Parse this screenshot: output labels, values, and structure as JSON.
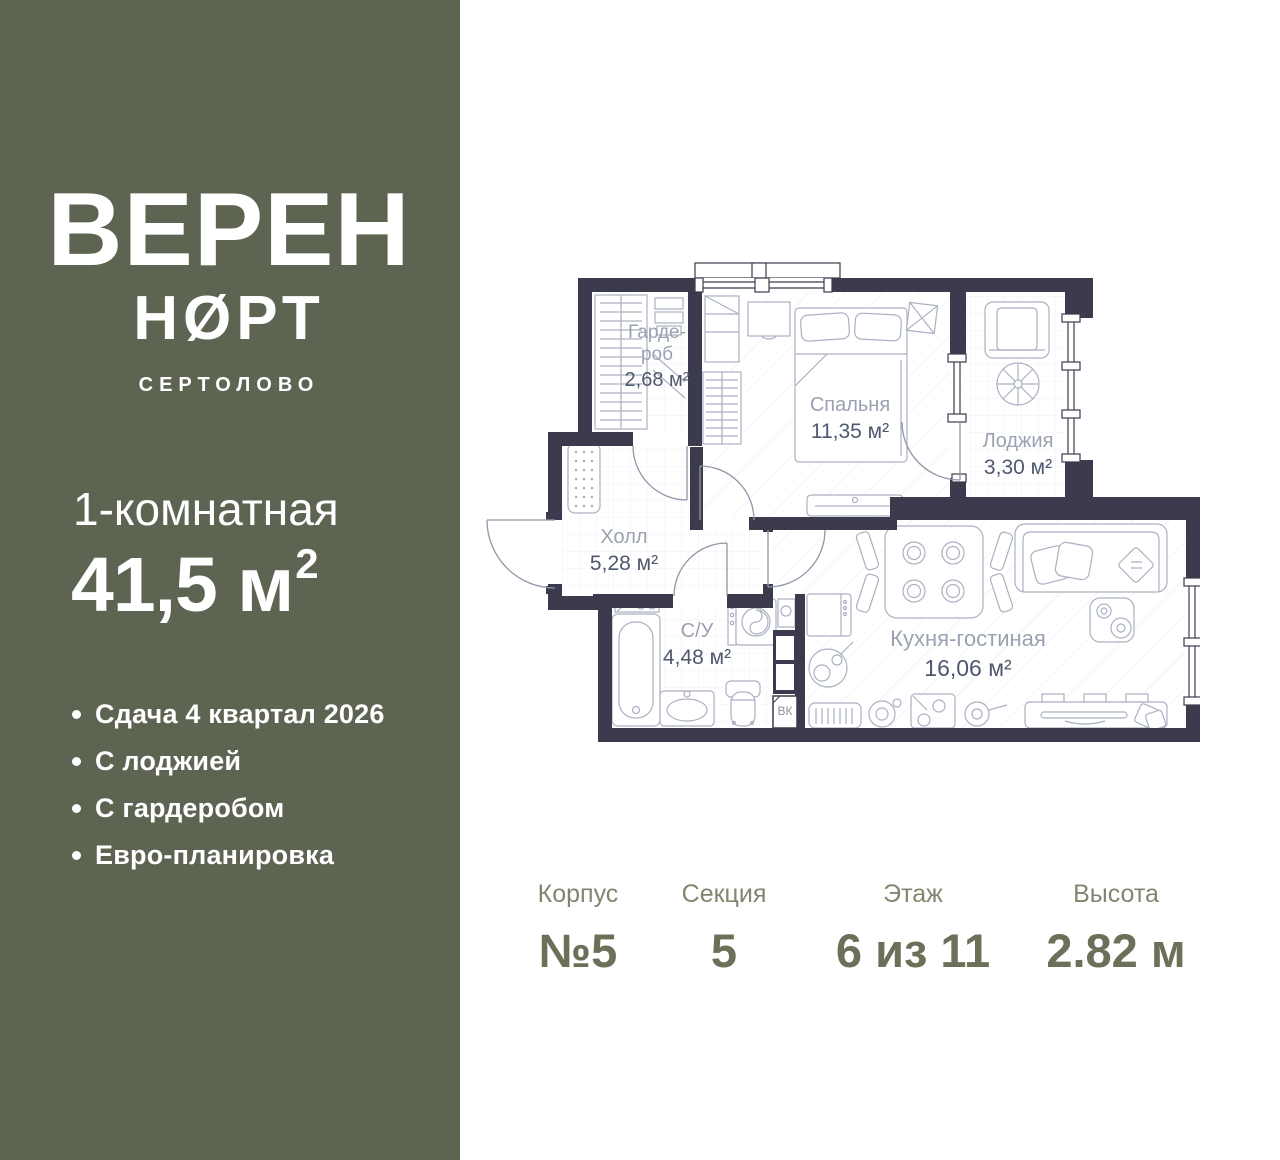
{
  "sidebar": {
    "brand": {
      "title": "ВЕРЕН",
      "subtitle": "НØРТ",
      "city": "СЕРТОЛОВО"
    },
    "apartment": {
      "type": "1-комнатная",
      "area": "41,5 м",
      "area_sup": "2"
    },
    "features": [
      "Сдача 4 квартал 2026",
      "С лоджией",
      "С гардеробом",
      "Евро-планировка"
    ]
  },
  "plan": {
    "rooms": [
      {
        "name": "Гарде-\nроб",
        "area": "2,68 м²"
      },
      {
        "name": "Спальня",
        "area": "11,35 м²"
      },
      {
        "name": "Лоджия",
        "area": "3,30 м²"
      },
      {
        "name": "Холл",
        "area": "5,28 м²"
      },
      {
        "name": "С/У",
        "area": "4,48 м²"
      },
      {
        "name": "Кухня-гостиная",
        "area": "16,06 м²"
      }
    ],
    "shaft_label": "ВК"
  },
  "info": {
    "columns": [
      {
        "label": "Корпус",
        "value": "№5"
      },
      {
        "label": "Секция",
        "value": "5"
      },
      {
        "label": "Этаж",
        "value": "6 из 11"
      },
      {
        "label": "Высота",
        "value": "2.82 м"
      }
    ]
  },
  "colors": {
    "sidebar": "#5e6452",
    "wall": "#3b3b4d",
    "accent_text": "#6b7059"
  }
}
